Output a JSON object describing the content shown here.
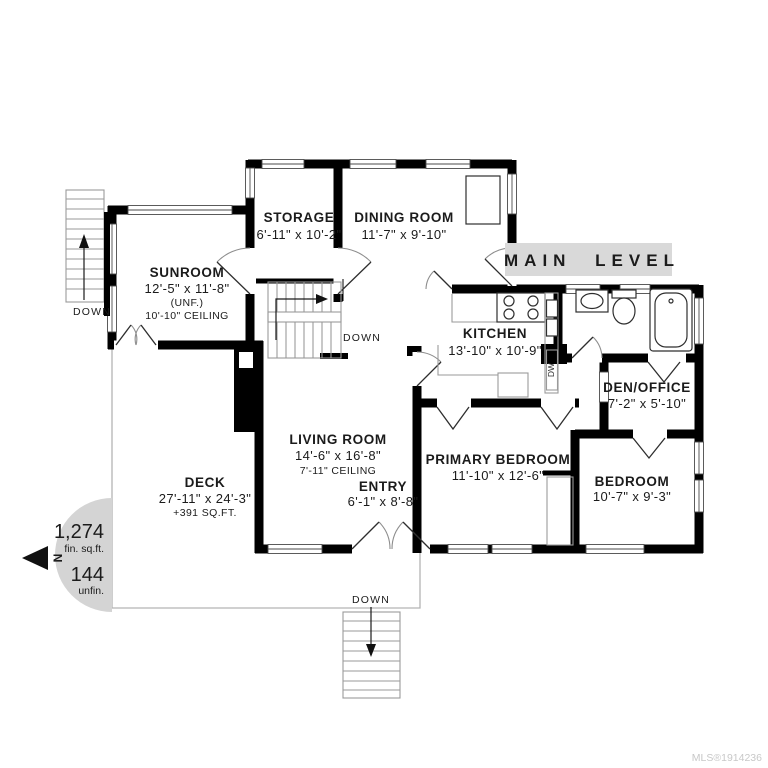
{
  "banner": {
    "label": "MAIN LEVEL"
  },
  "rooms": {
    "storage": {
      "name": "STORAGE",
      "dims": "6'-11\" x 10'-2\""
    },
    "dining_room": {
      "name": "DINING ROOM",
      "dims": "11'-7\" x 9'-10\""
    },
    "sunroom": {
      "name": "SUNROOM",
      "dims": "12'-5\" x 11'-8\"",
      "note": "(UNF.)",
      "ceiling": "10'-10\" CEILING"
    },
    "kitchen": {
      "name": "KITCHEN",
      "dims": "13'-10\" x 10'-9\""
    },
    "den_office": {
      "name": "DEN/OFFICE",
      "dims": "7'-2\" x 5'-10\""
    },
    "living_room": {
      "name": "LIVING ROOM",
      "dims": "14'-6\" x 16'-8\"",
      "ceiling": "7'-11\" CEILING"
    },
    "entry": {
      "name": "ENTRY",
      "dims": "6'-1\" x 8'-8\""
    },
    "primary_bedroom": {
      "name": "PRIMARY BEDROOM",
      "dims": "11'-10\" x 12'-6\""
    },
    "bedroom": {
      "name": "BEDROOM",
      "dims": "10'-7\" x 9'-3\""
    },
    "deck": {
      "name": "DECK",
      "dims": "27'-11\" x 24'-3\"",
      "extra": "+391 SQ.FT."
    }
  },
  "stairs": {
    "down_label": "DOWN"
  },
  "appliances": {
    "dishwasher": "DW"
  },
  "compass": {
    "north": "N",
    "finished_value": "1,274",
    "finished_unit": "fin. sq.ft.",
    "unfinished_value": "144",
    "unfinished_unit": "unfin."
  },
  "watermark": "MLS®1914236",
  "colors": {
    "wall": "#000000",
    "banner_bg": "#d9d9d9",
    "compass_bg": "#d4d4d4",
    "watermark": "#c8c8c8",
    "text": "#1b1b1b"
  }
}
